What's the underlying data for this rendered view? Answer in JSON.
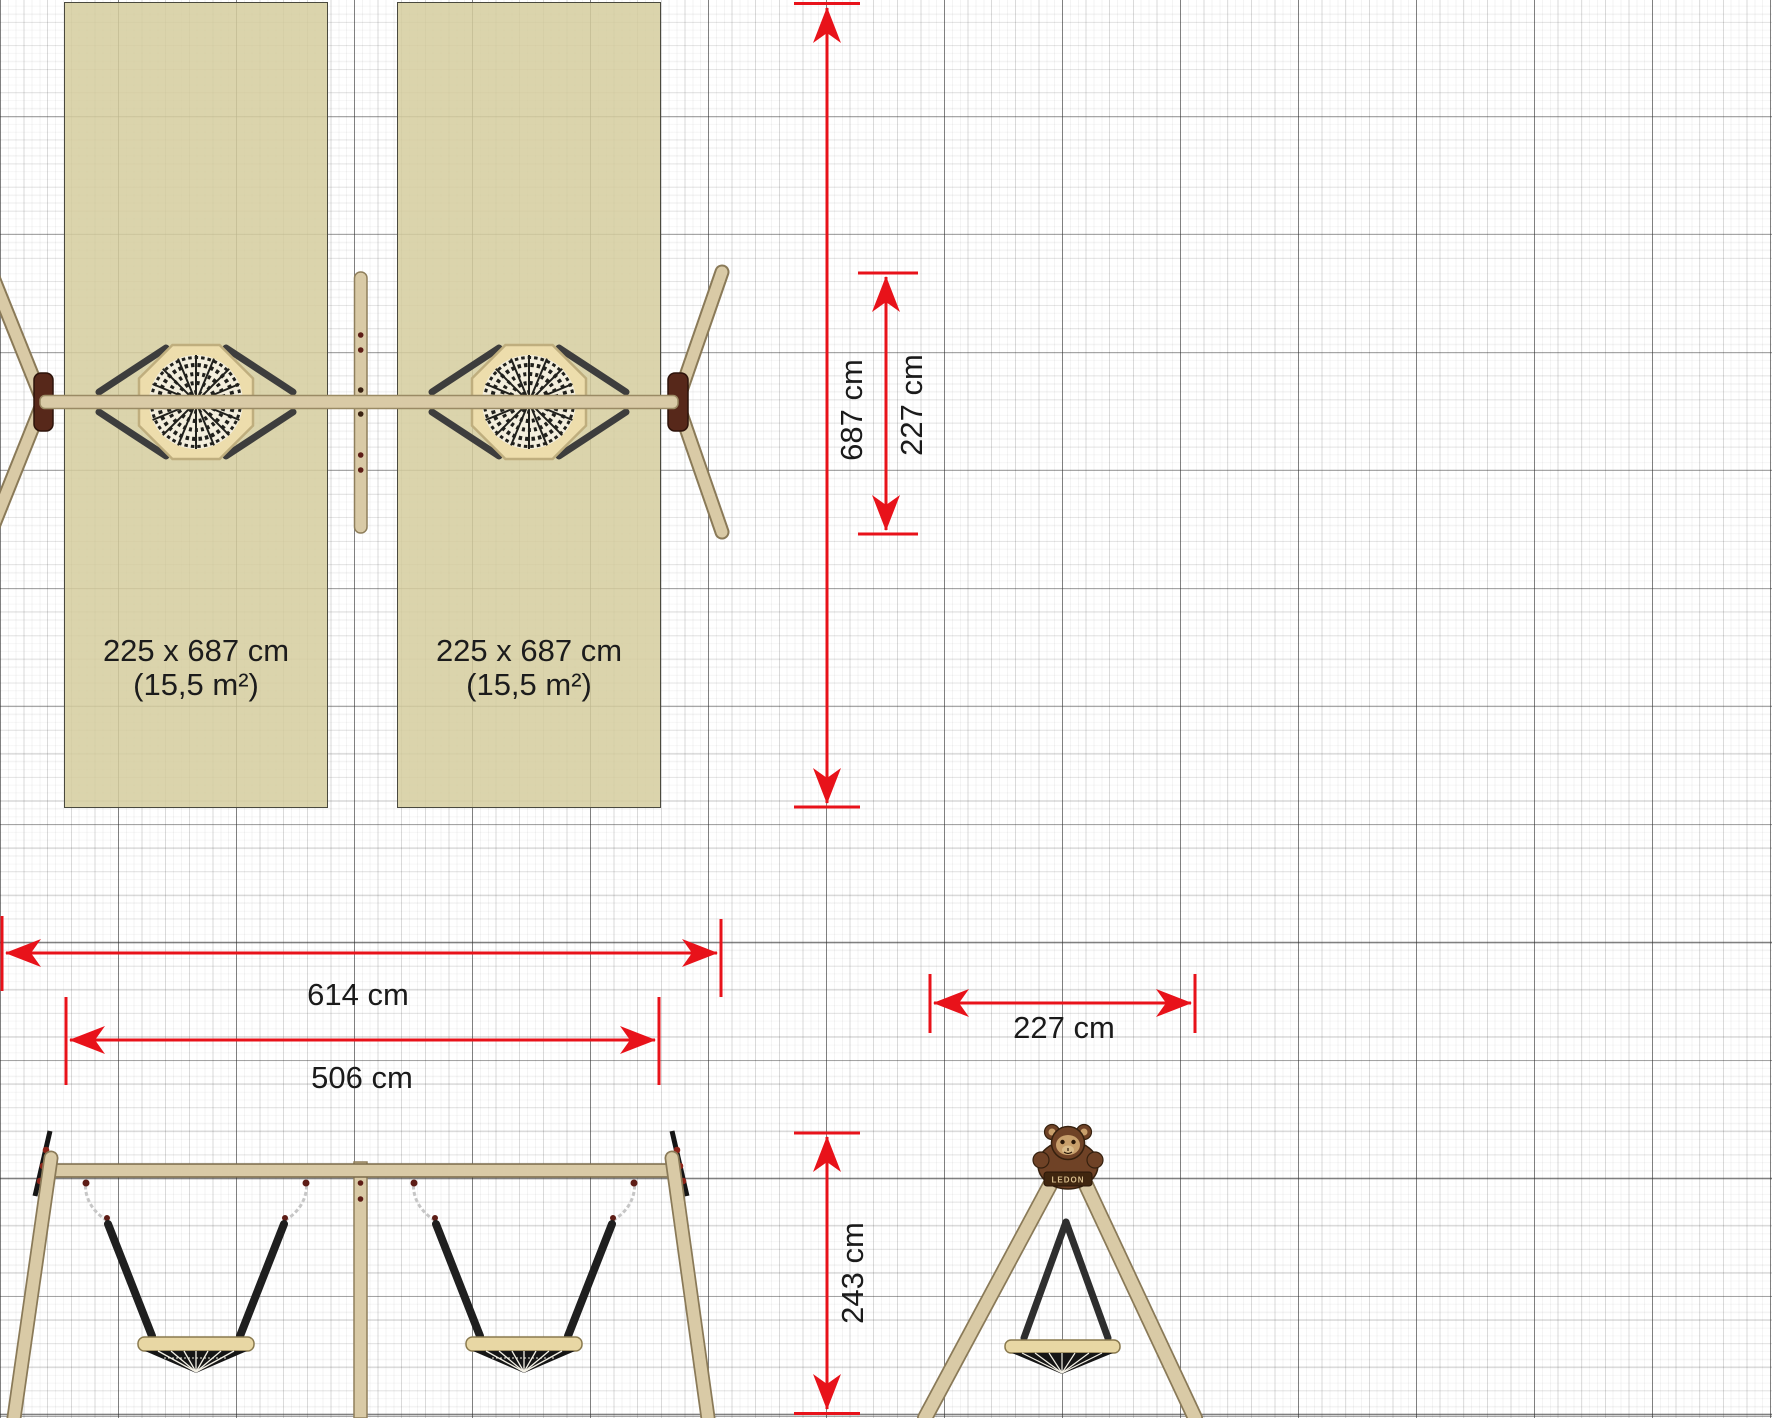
{
  "plan": {
    "safety_zones": [
      {
        "size": "225 x 687 cm",
        "area": "(15,5 m²)"
      },
      {
        "size": "225 x 687 cm",
        "area": "(15,5 m²)"
      }
    ],
    "dimensions": {
      "zone_length": "687 cm",
      "frame_depth": "227 cm",
      "total_width": "614 cm",
      "zone_total_width": "506 cm",
      "frame_width": "227 cm",
      "frame_height": "243 cm"
    },
    "brand": "LEDON",
    "colors": {
      "dimension_red": "#e8121a",
      "zone_fill": "#d5cd9e",
      "wood": "#d6c6a2",
      "rope": "#1f1f1f",
      "bracket_brown": "#57281a"
    }
  }
}
